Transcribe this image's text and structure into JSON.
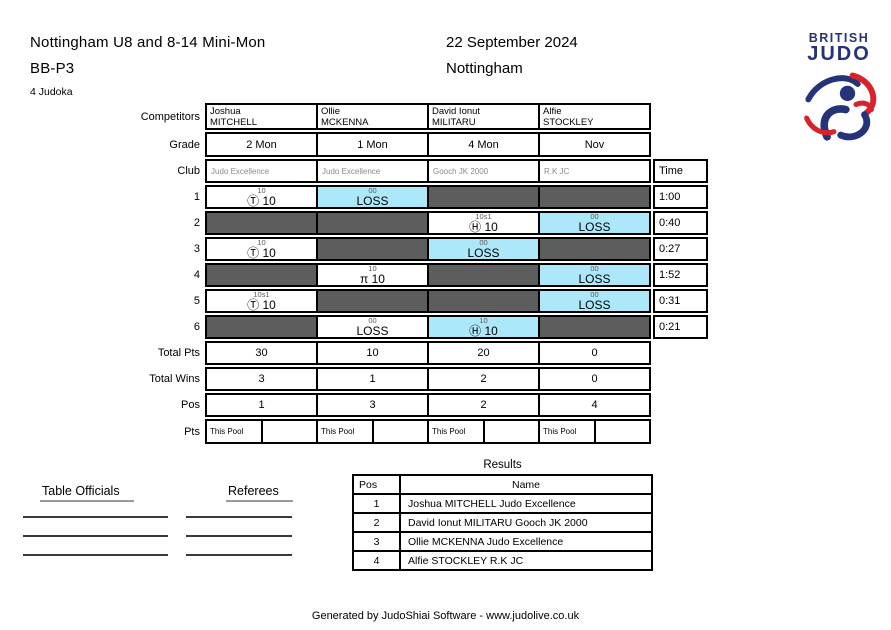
{
  "header": {
    "title_line1": "Nottingham U8 and 8-14 Mini-Mon",
    "title_line2": "BB-P3",
    "judoka_count": "4 Judoka",
    "date": "22 September 2024",
    "location": "Nottingham"
  },
  "logo": {
    "line1": "BRITISH",
    "line2": "JUDO",
    "figure": "judo-throw-swirl"
  },
  "colors": {
    "win_blue_cell": "#ace8fa",
    "bye_cell": "#5d5d5d",
    "club_text": "#8a8a8a",
    "logo_navy": "#25337a",
    "logo_red": "#d8232a"
  },
  "pool": {
    "labels": {
      "competitors": "Competitors",
      "grade": "Grade",
      "club": "Club",
      "time": "Time",
      "total_pts": "Total Pts",
      "total_wins": "Total Wins",
      "pos": "Pos",
      "pts": "Pts",
      "this_pool": "This Pool"
    },
    "competitors": [
      {
        "first": "Joshua",
        "last": "MITCHELL",
        "grade": "2 Mon",
        "club": "Judo Excellence"
      },
      {
        "first": "Ollie",
        "last": "MCKENNA",
        "grade": "1 Mon",
        "club": "Judo Excellence"
      },
      {
        "first": "David Ionut",
        "last": "MILITARU",
        "grade": "4 Mon",
        "club": "Gooch JK 2000"
      },
      {
        "first": "Alfie",
        "last": "STOCKLEY",
        "grade": "Nov",
        "club": "R.K JC"
      }
    ],
    "rows": [
      {
        "num": "1",
        "time": "1:00",
        "cells": [
          {
            "type": "white",
            "sub": "10",
            "main": "Ⓣ 10"
          },
          {
            "type": "blue",
            "sub": "00",
            "main": "LOSS"
          },
          {
            "type": "bye"
          },
          {
            "type": "bye"
          }
        ]
      },
      {
        "num": "2",
        "time": "0:40",
        "cells": [
          {
            "type": "bye"
          },
          {
            "type": "bye"
          },
          {
            "type": "white",
            "sub": "10s1",
            "main": "Ⓗ 10"
          },
          {
            "type": "blue",
            "sub": "00",
            "main": "LOSS"
          }
        ]
      },
      {
        "num": "3",
        "time": "0:27",
        "cells": [
          {
            "type": "white",
            "sub": "10",
            "main": "Ⓣ 10"
          },
          {
            "type": "bye"
          },
          {
            "type": "blue",
            "sub": "00",
            "main": "LOSS"
          },
          {
            "type": "bye"
          }
        ]
      },
      {
        "num": "4",
        "time": "1:52",
        "cells": [
          {
            "type": "bye"
          },
          {
            "type": "white",
            "sub": "10",
            "main": "π 10"
          },
          {
            "type": "bye"
          },
          {
            "type": "blue",
            "sub": "00",
            "main": "LOSS"
          }
        ]
      },
      {
        "num": "5",
        "time": "0:31",
        "cells": [
          {
            "type": "white",
            "sub": "10s1",
            "main": "Ⓣ 10"
          },
          {
            "type": "bye"
          },
          {
            "type": "bye"
          },
          {
            "type": "blue",
            "sub": "00",
            "main": "LOSS"
          }
        ]
      },
      {
        "num": "6",
        "time": "0:21",
        "cells": [
          {
            "type": "bye"
          },
          {
            "type": "white",
            "sub": "00",
            "main": "LOSS"
          },
          {
            "type": "blue",
            "sub": "10",
            "main": "Ⓗ 10"
          },
          {
            "type": "bye"
          }
        ]
      }
    ],
    "totals": {
      "pts": [
        "30",
        "10",
        "20",
        "0"
      ],
      "wins": [
        "3",
        "1",
        "2",
        "0"
      ],
      "pos": [
        "1",
        "3",
        "2",
        "4"
      ]
    }
  },
  "results": {
    "title": "Results",
    "headers": {
      "pos": "Pos",
      "name": "Name"
    },
    "rows": [
      {
        "pos": "1",
        "name": "Joshua MITCHELL Judo Excellence"
      },
      {
        "pos": "2",
        "name": "David Ionut MILITARU Gooch JK 2000"
      },
      {
        "pos": "3",
        "name": "Ollie MCKENNA Judo Excellence"
      },
      {
        "pos": "4",
        "name": "Alfie STOCKLEY R.K JC"
      }
    ]
  },
  "signatures": {
    "table_officials": "Table Officials",
    "referees": "Referees"
  },
  "footer": {
    "text": "Generated by JudoShiai Software - www.judolive.co.uk"
  }
}
